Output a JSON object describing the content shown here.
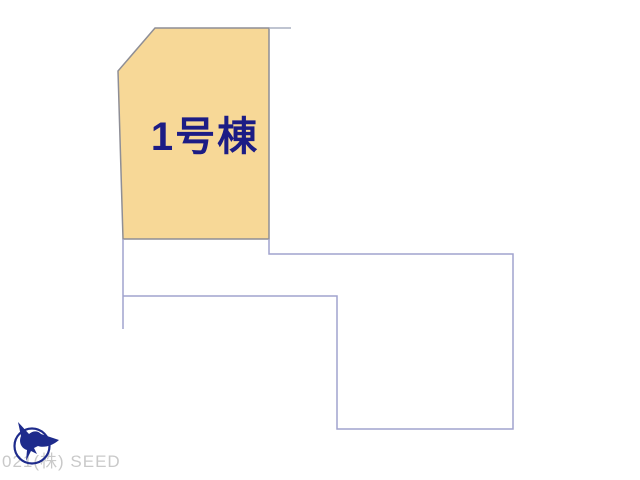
{
  "plan": {
    "lot1": {
      "label": "1号棟",
      "fill_color": "#f7d897",
      "border_color": "#8e8e96",
      "label_color": "#1c1c85"
    },
    "boundary_line_color": "#a1a3ce",
    "extension_line_color": "#aab0c2",
    "background_color": "#ffffff"
  },
  "watermark": {
    "text": "021(株) SEED",
    "color": "#c9c9c9"
  },
  "logo": {
    "icon": "seed-bird-logo",
    "color": "#1e2b8c"
  }
}
